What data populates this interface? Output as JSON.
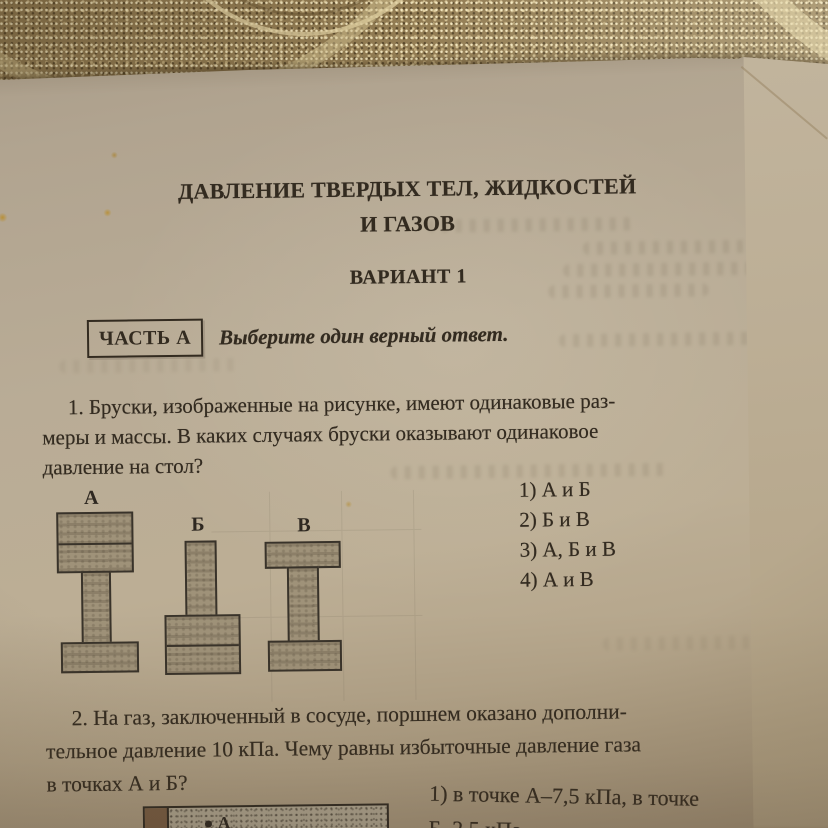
{
  "page": {
    "title_line1": "ДАВЛЕНИЕ ТВЕРДЫХ ТЕЛ, ЖИДКОСТЕЙ",
    "title_line2": "И ГАЗОВ",
    "variant": "ВАРИАНТ 1",
    "part_label": "ЧАСТЬ А",
    "instruction": "Выберите один верный ответ."
  },
  "question1": {
    "lines": [
      "1. Бруски, изображенные на рисунке, имеют одинаковые раз-",
      "меры и массы. В каких случаях бруски оказывают одинаковое",
      "давление на стол?"
    ],
    "options": [
      "1) А и Б",
      "2) Б и В",
      "3) А, Б и В",
      "4) А и В"
    ],
    "figure_labels": [
      "А",
      "Б",
      "В"
    ]
  },
  "question2": {
    "lines": [
      "2. На газ, заключенный в сосуде, поршнем оказано дополни-",
      "тельное давление 10 кПа. Чему равны избыточные давление газа",
      "в точках А и Б?"
    ],
    "answer_line1": "1) в точке А–7,5 кПа, в точке",
    "answer_line2": "Б–2,5 кПа",
    "figure_point_label": "А"
  },
  "colors": {
    "table_gold": "#927c53",
    "paper": "#b9ac96",
    "ink": "#332b20",
    "figure_fill": "#9f9279"
  }
}
